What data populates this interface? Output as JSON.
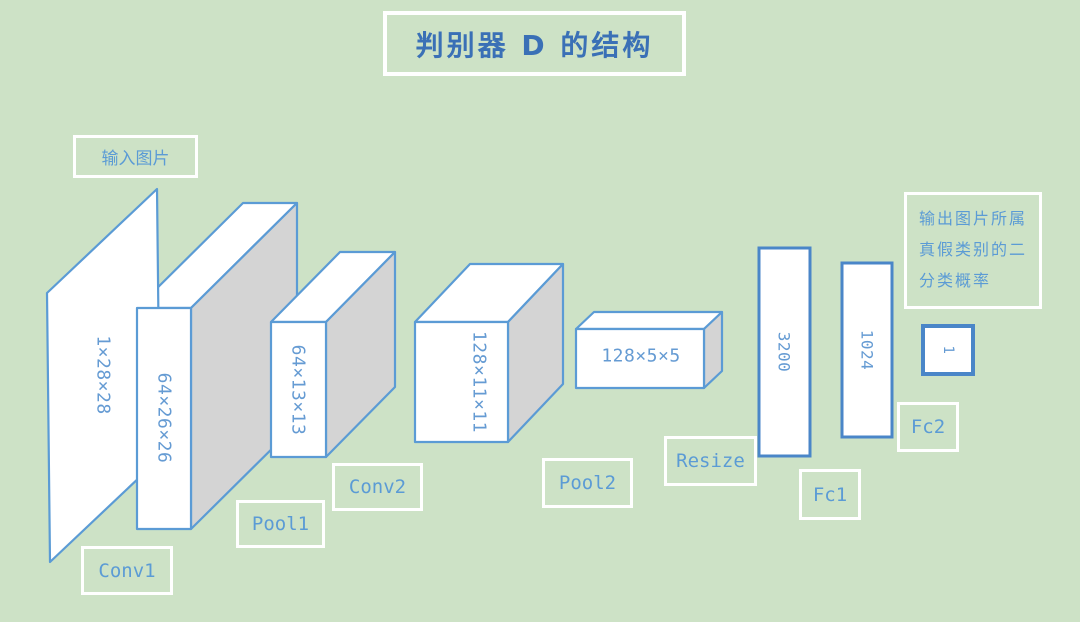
{
  "title": "判别器 D 的结构",
  "input_label": "输入图片",
  "output_label": {
    "line1": "输出图片所属",
    "line2": "真假类别的二",
    "line3": "分类概率"
  },
  "shapes": {
    "input_plane": "1×28×28",
    "conv1_out": "64×26×26",
    "pool1_out": "64×13×13",
    "conv2_out": "128×11×11",
    "pool2_out": "128×5×5",
    "resize_out": "3200",
    "fc1_out": "1024",
    "fc2_out": "1"
  },
  "ops": {
    "conv1": "Conv1",
    "pool1": "Pool1",
    "conv2": "Conv2",
    "pool2": "Pool2",
    "resize": "Resize",
    "fc1": "Fc1",
    "fc2": "Fc2"
  },
  "colors": {
    "background": "#cde2c6",
    "shape_stroke": "#5b9bd5",
    "shape_fill": "#ffffff",
    "side_face_gray": "#d4d4d4",
    "label_text": "#5b9bd5",
    "title_text": "#3a70b6",
    "box_border": "#ffffff"
  }
}
